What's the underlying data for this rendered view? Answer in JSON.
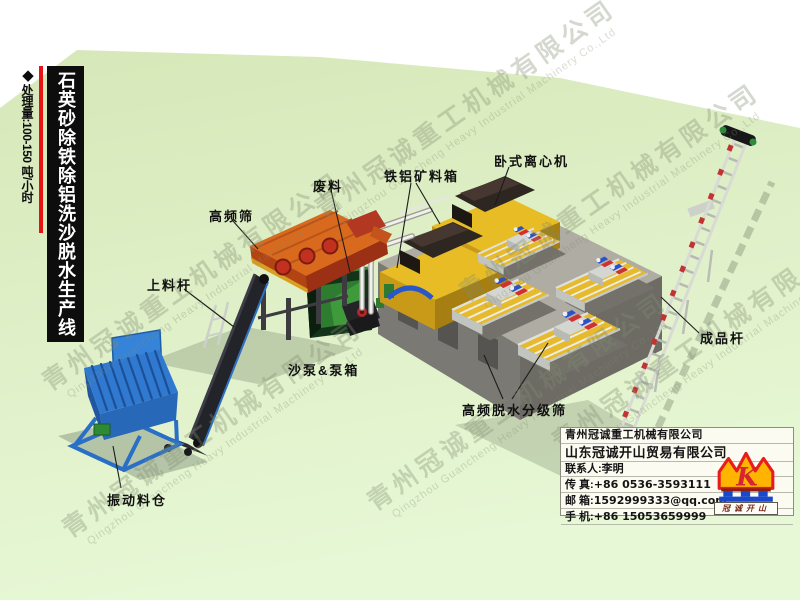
{
  "page": {
    "background": "#ffffff",
    "ground_green_top": "#d6e8b8",
    "ground_green_bottom": "#e7f8d6"
  },
  "banner": {
    "diamond": "◆",
    "capacity": "处理量:100-150 吨/小时",
    "title": "石英砂除铁除铝洗沙脱水生产线",
    "bar_color": "#0d0d0d",
    "accent_color": "#e81414"
  },
  "watermark": {
    "cn": "青州冠诚重工机械有限公司",
    "en": "Qingzhou Guancheng Heavy Industrial Machinery Co.,Ltd"
  },
  "labels": {
    "feed_conveyor": "上料杆",
    "hf_screen": "高频筛",
    "waste": "废料",
    "fe_al_ore_box": "铁铝矿料箱",
    "horizontal_centrifuge": "卧式离心机",
    "sand_pump_box": "沙泵&泵箱",
    "vibrating_hopper": "振动料仓",
    "hf_dewater_screen": "高频脱水分级筛",
    "product_conveyor": "成品杆"
  },
  "info_card": {
    "company_1": "青州冠诚重工机械有限公司",
    "company_2": "山东冠诚开山贸易有限公司",
    "contact": "联系人:李明",
    "rows": [
      {
        "label": "传  真:",
        "value": "+86 0536-3593111"
      },
      {
        "label": "邮  箱:",
        "value": "1592999333@qq.com"
      },
      {
        "label": "手  机:",
        "value": "+86 15053659999"
      }
    ],
    "logo_mark": "K",
    "logo_text": "冠诚开山",
    "logo_crown_fill": "#ffb400",
    "logo_crown_stroke": "#e81c1c",
    "logo_base_blue": "#1a48cc"
  }
}
